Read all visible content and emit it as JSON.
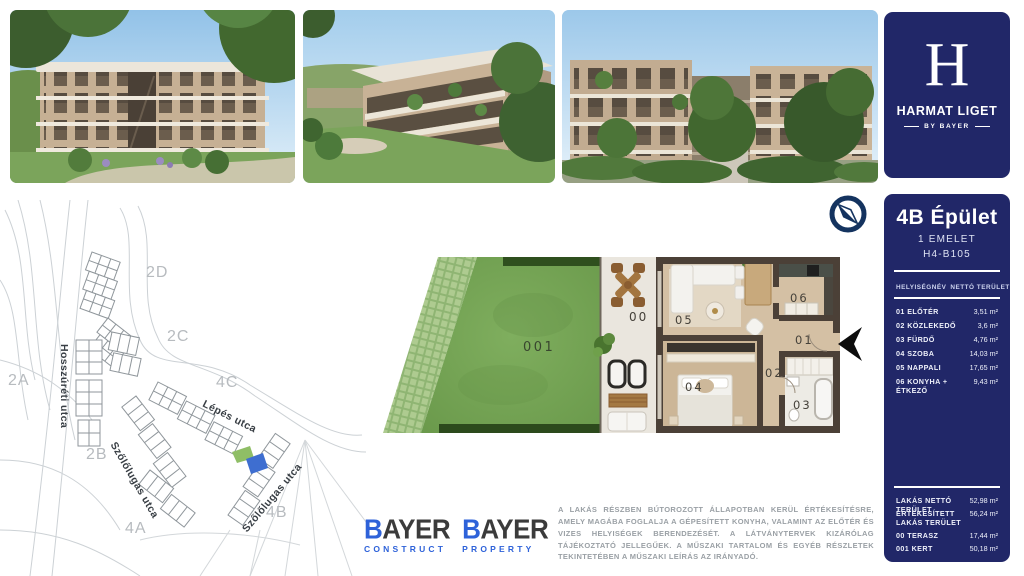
{
  "brand": {
    "initial": "H",
    "name": "HARMAT LIGET",
    "byline": "BY BAYER"
  },
  "unit_panel": {
    "building": "4B Épület",
    "floor": "1 EMELET",
    "unit_id": "H4-B105",
    "table": {
      "col_name": "HELYISÉGNÉV",
      "col_area": "NETTÓ TERÜLET",
      "rows": [
        {
          "name": "01 ELŐTÉR",
          "area": "3,51 m²"
        },
        {
          "name": "02 KÖZLEKEDŐ",
          "area": "3,6 m²"
        },
        {
          "name": "03 FÜRDŐ",
          "area": "4,76 m²"
        },
        {
          "name": "04 SZOBA",
          "area": "14,03 m²"
        },
        {
          "name": "05 NAPPALI",
          "area": "17,65 m²"
        },
        {
          "name": "06 KONYHA + ÉTKEZŐ",
          "area": "9,43 m²"
        }
      ]
    },
    "totals": [
      {
        "name": "LAKÁS NETTÓ TERÜLET",
        "area": "52,98 m²"
      },
      {
        "name": "ÉRTÉKESÍTETT LAKÁS TERÜLET",
        "area": "56,24 m²"
      },
      {
        "name": "00 TERASZ",
        "area": "17,44 m²"
      },
      {
        "name": "001 KERT",
        "area": "50,18 m²"
      }
    ]
  },
  "site_map": {
    "block_labels": [
      "2D",
      "2C",
      "2A",
      "4C",
      "2B",
      "4A",
      "4B"
    ],
    "street_labels": [
      "Hosszúréti utca",
      "Lépés utca",
      "Szőlőlugas utca",
      "Szőlőlugas utca"
    ]
  },
  "floor_plan": {
    "labels": {
      "garden": "001",
      "terrace": "00",
      "entry": "01",
      "hall": "02",
      "bath": "03",
      "room": "04",
      "living": "05",
      "kitchen": "06"
    }
  },
  "footer": {
    "logos": [
      {
        "initial": "B",
        "rest": "AYER",
        "division": "CONSTRUCT"
      },
      {
        "initial": "B",
        "rest": "AYER",
        "division": "PROPERTY"
      }
    ],
    "disclaimer": "A LAKÁS RÉSZBEN BÚTOROZOTT ÁLLAPOTBAN KERÜL ÉRTÉKESÍTÉSRE, AMELY MAGÁBA FOGLALJA A GÉPESÍTETT KONYHA, VALAMINT AZ ELŐTÉR ÉS VIZES HELYISÉGEK BERENDEZÉSÉT. A LÁTVÁNYTERVEK KIZÁRÓLAG TÁJÉKOZTATÓ JELLEGŰEK. A MŰSZAKI TARTALOM ÉS EGYÉB RÉSZLETEK TEKINTETÉBEN A MŰSZAKI LEÍRÁS AZ IRÁNYADÓ."
  },
  "colors": {
    "navy_panel": "#212768",
    "compass_navy": "#14335f",
    "accent_blue": "#2e62d9",
    "grass_green": "#74a355",
    "wall_brown": "#4b4037"
  }
}
